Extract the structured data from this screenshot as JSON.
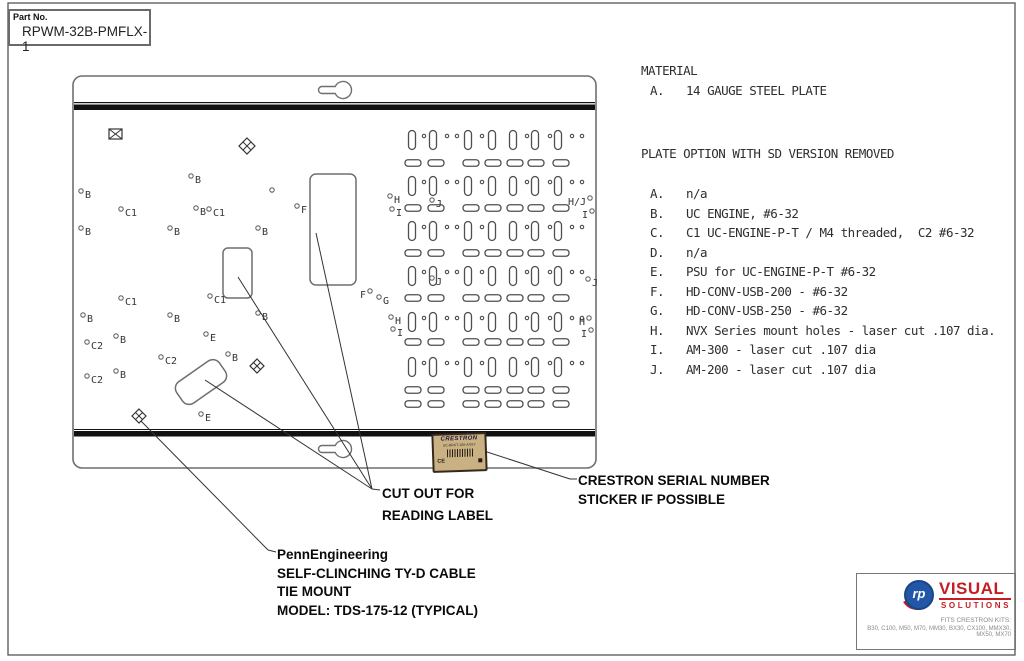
{
  "sheet": {
    "part_no_label": "Part No.",
    "part_no_value": "RPWM-32B-PMFLX-1"
  },
  "notes": {
    "material_title": "MATERIAL",
    "material_item": {
      "letter": "A.",
      "text": "14 GAUGE STEEL PLATE"
    },
    "options_title": "PLATE OPTION WITH SD VERSION REMOVED",
    "option_items": [
      {
        "letter": "A.",
        "text": "n/a"
      },
      {
        "letter": "B.",
        "text": "UC ENGINE, #6-32"
      },
      {
        "letter": "C.",
        "text": "C1 UC-ENGINE-P-T / M4 threaded,  C2 #6-32"
      },
      {
        "letter": "D.",
        "text": "n/a"
      },
      {
        "letter": "E.",
        "text": "PSU for UC-ENGINE-P-T #6-32"
      },
      {
        "letter": "F.",
        "text": "HD-CONV-USB-200 - #6-32"
      },
      {
        "letter": "G.",
        "text": "HD-CONV-USB-250 - #6-32"
      },
      {
        "letter": "H.",
        "text": "NVX Series mount holes - laser cut .107 dia."
      },
      {
        "letter": "I.",
        "text": "AM-300 - laser cut .107 dia"
      },
      {
        "letter": "J.",
        "text": "AM-200 - laser cut .107 dia"
      }
    ]
  },
  "callouts": {
    "cutout": [
      "CUT OUT FOR",
      "READING LABEL"
    ],
    "serial": [
      "CRESTRON  SERIAL NUMBER",
      "STICKER IF POSSIBLE"
    ],
    "tie_mount": [
      "PennEngineering",
      "SELF-CLINCHING TY-D CABLE",
      "TIE MOUNT",
      "MODEL: TDS-175-12 (TYPICAL)"
    ]
  },
  "sticker": {
    "brand": "CRESTRON",
    "model": "UC-BRKT-100-ASSY",
    "ce": "CE"
  },
  "logo": {
    "monogram": "rp",
    "word1": "VISUAL",
    "word2": "SOLUTIONS",
    "fits_title": "FITS CRESTRON KITS:",
    "fits_list": "B30, C100, M50, M70, MM30, BX30, CX100, MMX30, MX50, MX70"
  },
  "colors": {
    "frame": "#555555",
    "plate_line": "#6f6f6f",
    "band": "#111111",
    "pattern_line": "#4f4f4f",
    "marker_line": "#666666",
    "marker_text": "#333333",
    "leader": "#333333",
    "sticker_bg": "#c9b183",
    "logo_blue": "#2157a6",
    "logo_red": "#c41e24"
  },
  "plate": {
    "outline": {
      "x": 73,
      "y": 76,
      "w": 523,
      "h": 392,
      "r": 9
    },
    "bands": [
      {
        "y": 102,
        "h": 1.2
      },
      {
        "y": 104.5,
        "h": 5.5
      },
      {
        "y": 429,
        "h": 1
      },
      {
        "y": 431,
        "h": 5.5
      }
    ],
    "keyholes": [
      {
        "cx": 343,
        "cy": 90
      },
      {
        "cx": 343,
        "cy": 449
      }
    ],
    "envelope": {
      "x": 109,
      "y": 129,
      "w": 13,
      "h": 10
    },
    "diamonds": [
      {
        "cx": 247,
        "cy": 146,
        "s": 8
      },
      {
        "cx": 257,
        "cy": 366,
        "s": 7
      },
      {
        "cx": 139,
        "cy": 416,
        "s": 7
      }
    ],
    "cutouts": [
      {
        "x": 310,
        "y": 174,
        "w": 46,
        "h": 111,
        "r": 6,
        "rot": 0,
        "cx": 333,
        "cy": 229
      },
      {
        "x": 223,
        "y": 248,
        "w": 29,
        "h": 50,
        "r": 5,
        "rot": 0,
        "cx": 237,
        "cy": 273
      },
      {
        "x": 175,
        "y": 369,
        "w": 52,
        "h": 26,
        "r": 8,
        "rot": -35,
        "cx": 201,
        "cy": 382
      }
    ],
    "pattern": {
      "vrow_ys": [
        140,
        186,
        231,
        276,
        322,
        367
      ],
      "vslot_xs": [
        412,
        433,
        468,
        492,
        513,
        535,
        558
      ],
      "vslot": {
        "w": 7,
        "h": 19,
        "r": 3.5
      },
      "vcircle_xs": [
        424,
        447,
        457,
        482,
        527,
        550,
        572,
        582
      ],
      "hrow_ys": [
        163,
        208,
        253,
        298,
        342,
        390,
        404
      ],
      "hslot_xs": [
        413,
        436,
        471,
        493,
        515,
        536,
        561
      ],
      "hslot": {
        "w": 16,
        "h": 6.5,
        "r": 3
      }
    },
    "markers": [
      {
        "x": 191,
        "y": 176,
        "t": "B"
      },
      {
        "x": 272,
        "y": 190,
        "t": ""
      },
      {
        "x": 81,
        "y": 191,
        "t": "B"
      },
      {
        "x": 121,
        "y": 209,
        "t": "C1"
      },
      {
        "x": 196,
        "y": 208,
        "t": "B"
      },
      {
        "x": 209,
        "y": 209,
        "t": "C1"
      },
      {
        "x": 297,
        "y": 206,
        "t": "F"
      },
      {
        "x": 81,
        "y": 228,
        "t": "B"
      },
      {
        "x": 170,
        "y": 228,
        "t": "B"
      },
      {
        "x": 258,
        "y": 228,
        "t": "B"
      },
      {
        "x": 121,
        "y": 298,
        "t": "C1"
      },
      {
        "x": 210,
        "y": 296,
        "t": "C1"
      },
      {
        "x": 83,
        "y": 315,
        "t": "B"
      },
      {
        "x": 170,
        "y": 315,
        "t": "B"
      },
      {
        "x": 258,
        "y": 313,
        "t": "B"
      },
      {
        "x": 116,
        "y": 336,
        "t": "B"
      },
      {
        "x": 206,
        "y": 334,
        "t": "E"
      },
      {
        "x": 87,
        "y": 342,
        "t": "C2"
      },
      {
        "x": 228,
        "y": 354,
        "t": "B"
      },
      {
        "x": 161,
        "y": 357,
        "t": "C2"
      },
      {
        "x": 116,
        "y": 371,
        "t": "B"
      },
      {
        "x": 87,
        "y": 376,
        "t": "C2"
      },
      {
        "x": 201,
        "y": 414,
        "t": "E"
      },
      {
        "x": 370,
        "y": 291,
        "t": "F",
        "side": "l"
      },
      {
        "x": 379,
        "y": 297,
        "t": "G"
      },
      {
        "x": 390,
        "y": 196,
        "t": "H"
      },
      {
        "x": 392,
        "y": 209,
        "t": "I"
      },
      {
        "x": 432,
        "y": 200,
        "t": "J"
      },
      {
        "x": 590,
        "y": 198,
        "t": "H/J",
        "side": "l"
      },
      {
        "x": 592,
        "y": 211,
        "t": "I",
        "side": "l"
      },
      {
        "x": 432,
        "y": 278,
        "t": "J"
      },
      {
        "x": 588,
        "y": 279,
        "t": "J"
      },
      {
        "x": 391,
        "y": 317,
        "t": "H"
      },
      {
        "x": 393,
        "y": 329,
        "t": "I"
      },
      {
        "x": 589,
        "y": 318,
        "t": "H",
        "side": "l"
      },
      {
        "x": 591,
        "y": 330,
        "t": "I",
        "side": "l"
      }
    ],
    "leaders": [
      [
        316,
        233,
        372,
        489
      ],
      [
        238,
        277,
        372,
        489
      ],
      [
        205,
        380,
        372,
        489
      ],
      [
        372,
        489,
        380,
        490
      ],
      [
        484,
        451,
        570,
        479
      ],
      [
        570,
        479,
        577,
        479
      ],
      [
        141,
        421,
        268,
        550
      ],
      [
        268,
        550,
        276,
        552
      ]
    ],
    "frame": {
      "x": 8,
      "y": 3,
      "w": 1007,
      "h": 652
    }
  }
}
